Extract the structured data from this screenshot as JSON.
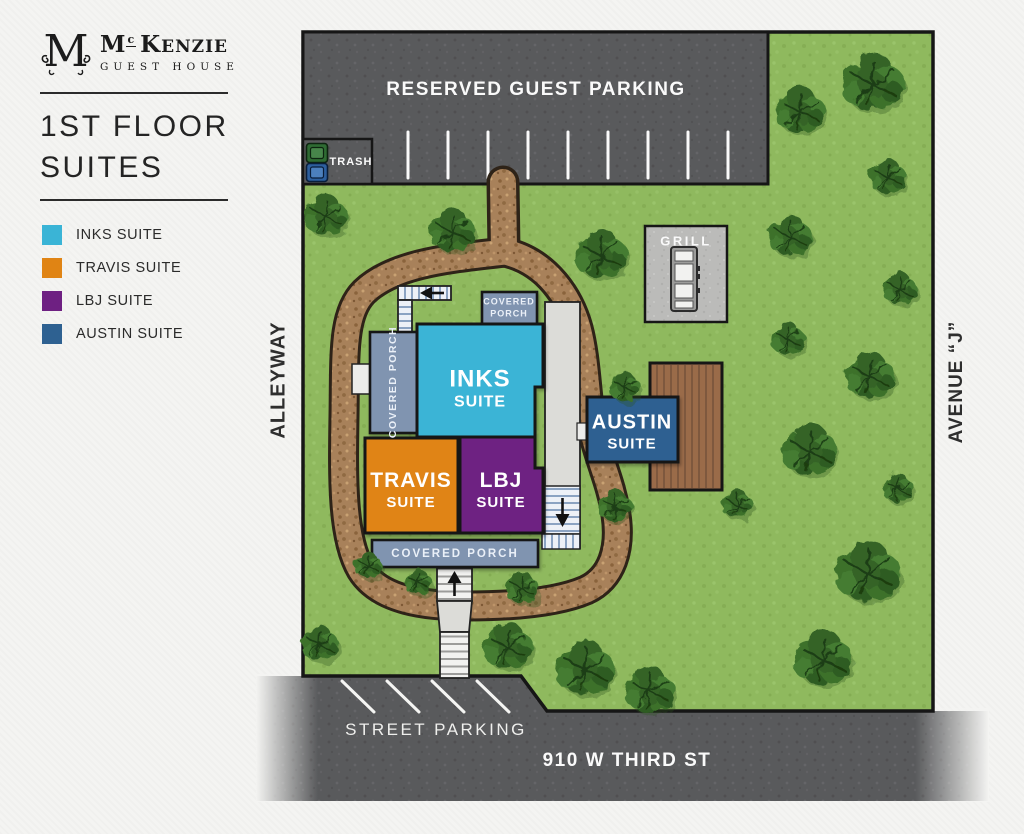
{
  "logo": {
    "monogram": "M",
    "word1_initial": "M",
    "word1_super": "c",
    "word2_initial": "K",
    "word2_rest": "ENZIE",
    "subtitle": "GUEST HOUSE"
  },
  "title": {
    "line1": "1ST FLOOR",
    "line2": "SUITES"
  },
  "legend": {
    "items": [
      {
        "label": "INKS SUITE",
        "color": "#3AB4D6"
      },
      {
        "label": "TRAVIS SUITE",
        "color": "#E08414"
      },
      {
        "label": "LBJ SUITE",
        "color": "#6E2082"
      },
      {
        "label": "AUSTIN SUITE",
        "color": "#2E6191"
      }
    ]
  },
  "map": {
    "parking": {
      "reserved_label": "RESERVED GUEST PARKING",
      "trash_label": "TRASH",
      "street_parking_label": "STREET PARKING"
    },
    "streets": {
      "alleyway": "ALLEYWAY",
      "avenue_j": "AVENUE “J”",
      "third_street": "910 W THIRD ST"
    },
    "amenities": {
      "grill_label": "GRILL",
      "covered_porch_word1": "COVERED",
      "covered_porch_word2": "PORCH",
      "covered_porch_label": "COVERED PORCH"
    },
    "suites": {
      "inks": {
        "name": "INKS",
        "type": "SUITE"
      },
      "travis": {
        "name": "TRAVIS",
        "type": "SUITE"
      },
      "lbj": {
        "name": "LBJ",
        "type": "SUITE"
      },
      "austin": {
        "name": "AUSTIN",
        "type": "SUITE"
      }
    }
  },
  "colors": {
    "grass": "#8FB95E",
    "road": "#595A5C",
    "dirt_path": "#A8815A",
    "walkway": "#DCDCD8",
    "porch": "#8094B0",
    "deck": "#9A6B49",
    "map_border": "#161616"
  }
}
